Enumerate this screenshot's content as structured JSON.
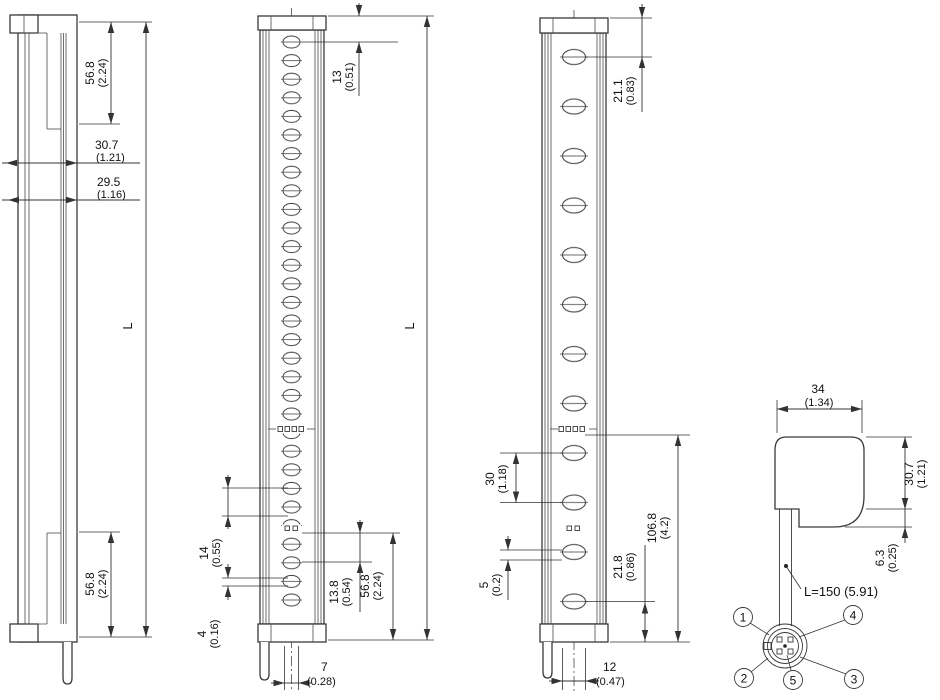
{
  "views": {
    "side": {
      "label_length": "L",
      "dim_top_bracket": [
        "56.8",
        "(2.24)"
      ],
      "dim_depth_total": [
        "30.7",
        "(1.21)"
      ],
      "dim_depth_front": [
        "29.5",
        "(1.16)"
      ],
      "dim_bottom_bracket": [
        "56.8",
        "(2.24)"
      ]
    },
    "front_fine": {
      "label_length": "L",
      "dim_top_to_first_beam": [
        "13",
        "(0.51)"
      ],
      "dim_beam_pitch": [
        "14",
        "(0.55)"
      ],
      "dim_lens_height": [
        "4",
        "(0.16)"
      ],
      "dim_last_beam_to_bottom": [
        "13.8",
        "(0.54)"
      ],
      "dim_bottom_bracket": [
        "56.8",
        "(2.24)"
      ],
      "dim_cable_offset": [
        "7",
        "(0.28)"
      ]
    },
    "front_coarse": {
      "dim_top_to_first_beam": [
        "21.1",
        "(0.83)"
      ],
      "dim_beam_pitch": [
        "30",
        "(1.18)"
      ],
      "dim_lens_height": [
        "5",
        "(0.2)"
      ],
      "dim_last_beam_to_bottom": [
        "21.8",
        "(0.86)"
      ],
      "dim_indicator_to_bottom": [
        "106.8",
        "(4.2)"
      ],
      "dim_cable_offset": [
        "12",
        "(0.47)"
      ]
    },
    "cross_section": {
      "dim_width": [
        "34",
        "(1.34)"
      ],
      "dim_height": [
        "30.7",
        "(1.21)"
      ],
      "dim_cable_exit": [
        "6.3",
        "(0.25)"
      ],
      "cable_length_label": "L=150 (5.91)",
      "pin_numbers": [
        "1",
        "2",
        "3",
        "4",
        "5"
      ]
    }
  }
}
